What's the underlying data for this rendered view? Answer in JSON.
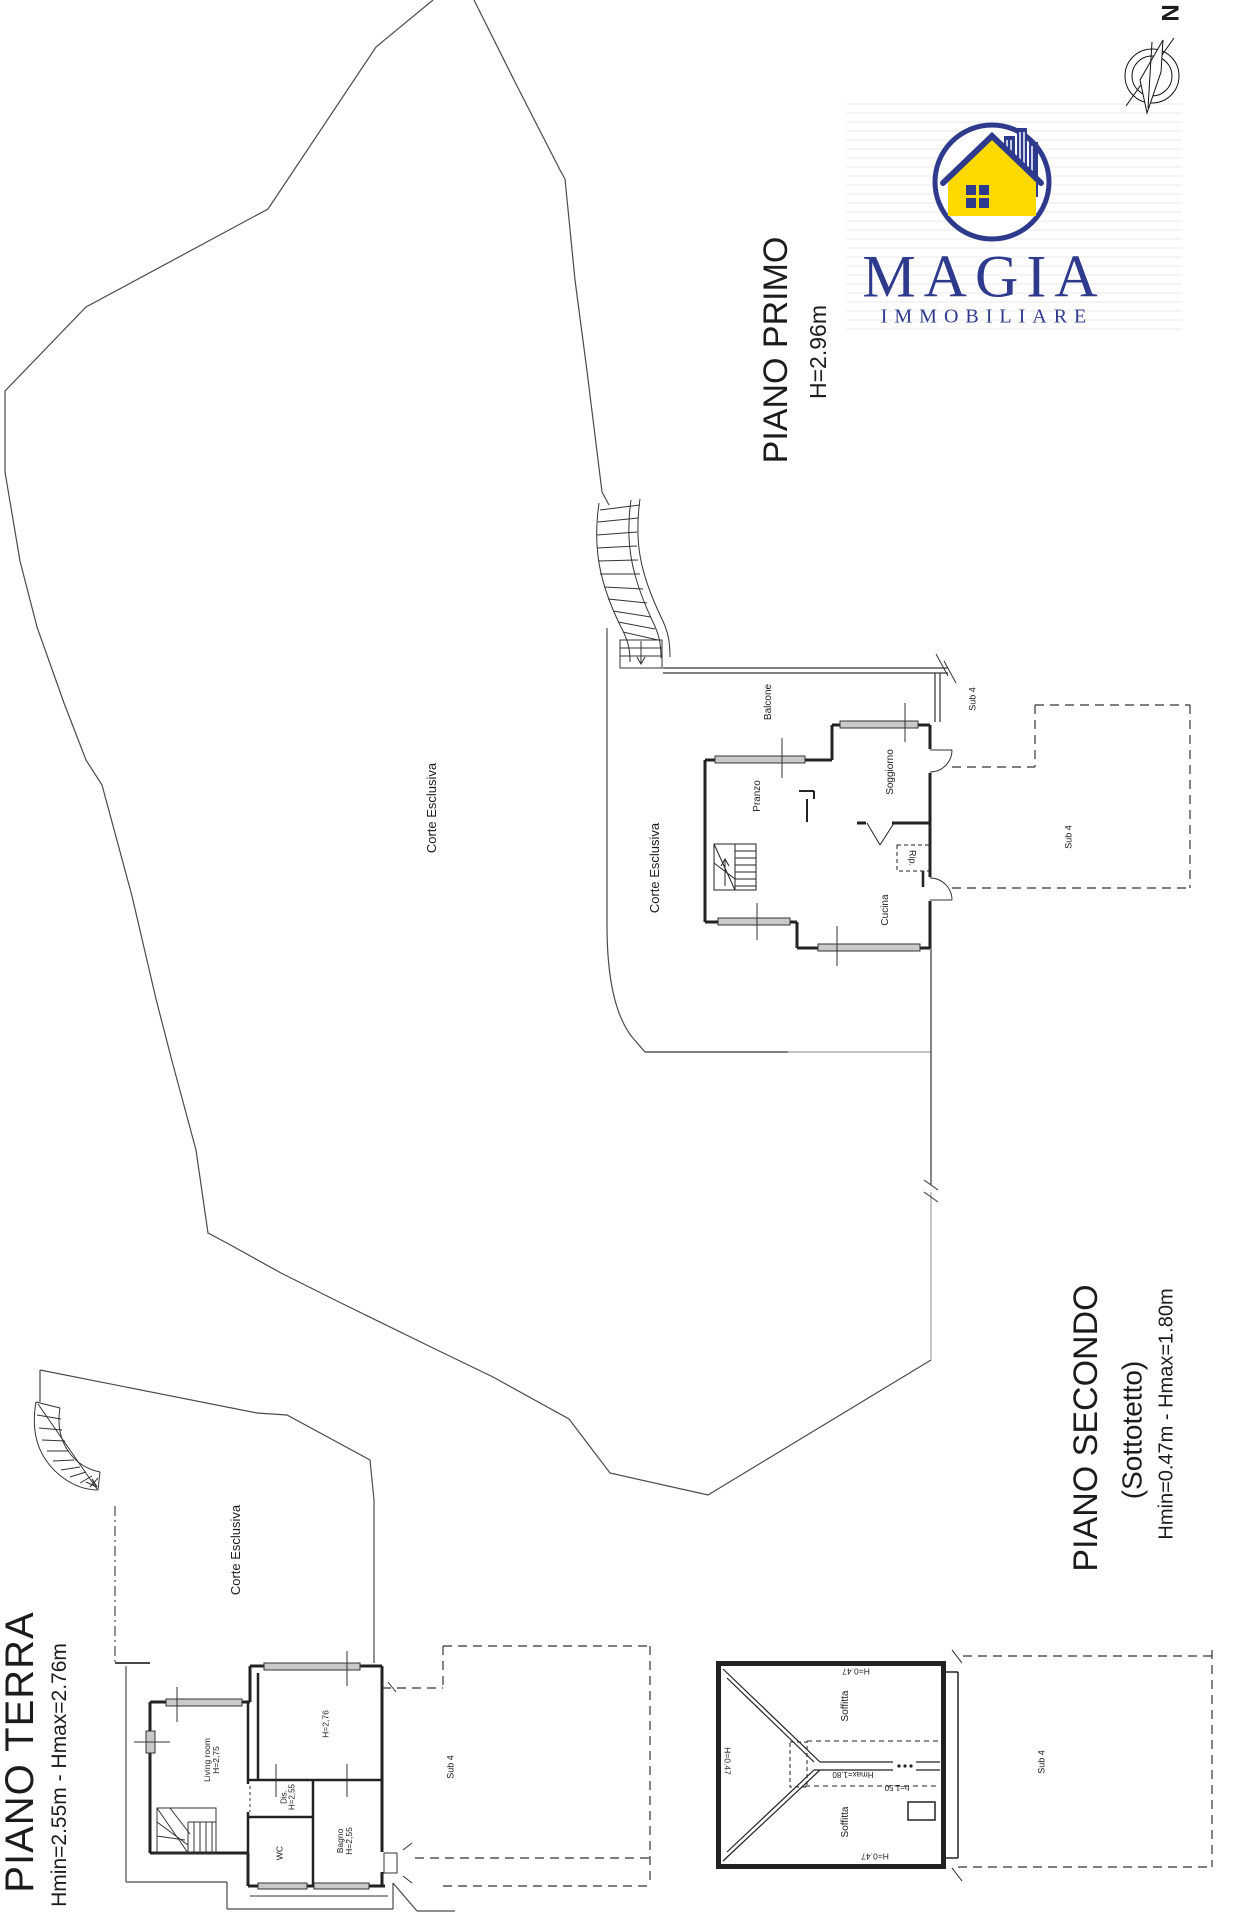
{
  "compass": {
    "north_label": "N"
  },
  "logo": {
    "brand": "MAGIA",
    "subbrand": "IMMOBILIARE",
    "blue": "#2e3a8c",
    "yellow": "#ffd900"
  },
  "floors": {
    "primo": {
      "title": "PIANO PRIMO",
      "height_note": "H=2.96m",
      "labels": {
        "corte1": "Corte Esclusiva",
        "corte2": "Corte Esclusiva",
        "balcone": "Balcone",
        "pranzo": "Pranzo",
        "soggiorno": "Soggiorno",
        "cucina": "Cucina",
        "rip": "Rip.",
        "sub4_top": "Sub 4",
        "sub4_right": "Sub 4"
      }
    },
    "terra": {
      "title": "PIANO TERRA",
      "height_note": "Hmin=2.55m - Hmax=2.76m",
      "labels": {
        "corte": "Corte Esclusiva",
        "living": "Living room",
        "living_h": "H=2,75",
        "big_room_h": "H=2,76",
        "dis": "Dis.",
        "dis_h": "H=2,55",
        "wc": "WC",
        "bagno": "Bagno",
        "bagno_h": "H=2,55",
        "sub4": "Sub 4"
      }
    },
    "secondo": {
      "title": "PIANO SECONDO",
      "subtitle": "(Sottotetto)",
      "height_note": "Hmin=0.47m - Hmax=1.80m",
      "labels": {
        "soffitta_top": "Soffitta",
        "soffitta_bottom": "Soffitta",
        "h_top": "H=0.47",
        "h_bottom": "H=0.47",
        "h_left": "H=0.47",
        "hmax": "Hmax=1.80",
        "h150": "h=1.50",
        "sub4": "Sub 4"
      }
    }
  }
}
